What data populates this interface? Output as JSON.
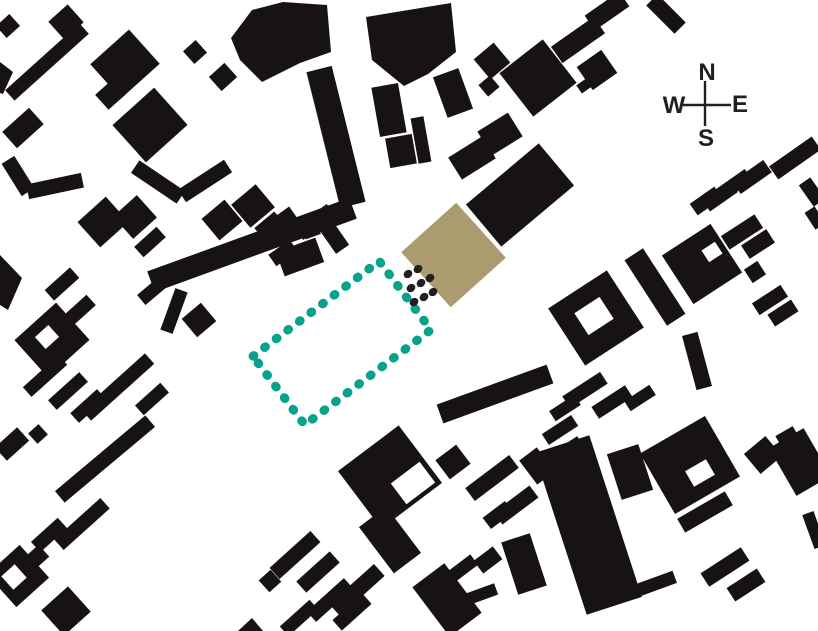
{
  "page": {
    "title": "Figure-ground site plan"
  },
  "colors": {
    "background": "#ffffff",
    "building": "#171314",
    "ink": "#231f20",
    "site_fill": "#ab9c6f",
    "boundary_teal": "#07a28b"
  },
  "compass": {
    "north": "N",
    "east": "E",
    "south": "S",
    "west": "W"
  },
  "map": {
    "width": 818,
    "height": 631,
    "buildings": [
      [
        8,
        26,
        18,
        16,
        -42
      ],
      [
        47,
        62,
        100,
        14,
        -42
      ],
      [
        66,
        22,
        26,
        24,
        -42
      ],
      [
        125,
        64,
        52,
        46,
        -42
      ],
      [
        110,
        95,
        22,
        20,
        -42
      ],
      [
        150,
        125,
        56,
        50,
        -42
      ],
      [
        23,
        128,
        36,
        22,
        -42
      ],
      [
        195,
        52,
        17,
        17,
        -42
      ],
      [
        223,
        77,
        21,
        19,
        -42
      ],
      [
        18,
        176,
        38,
        15,
        58
      ],
      [
        55,
        186,
        56,
        15,
        -12
      ],
      [
        158,
        182,
        55,
        15,
        34
      ],
      [
        205,
        181,
        55,
        15,
        -33
      ],
      [
        62,
        284,
        34,
        14,
        -42
      ],
      [
        52,
        340,
        56,
        50,
        -42
      ],
      [
        80,
        310,
        30,
        14,
        -42
      ],
      [
        103,
        222,
        38,
        34,
        -42
      ],
      [
        135,
        217,
        32,
        30,
        -42
      ],
      [
        150,
        242,
        30,
        14,
        -42
      ],
      [
        252,
        245,
        215,
        22,
        -20
      ],
      [
        222,
        220,
        30,
        28,
        -40
      ],
      [
        253,
        206,
        32,
        30,
        -40
      ],
      [
        272,
        229,
        26,
        24,
        -40
      ],
      [
        300,
        257,
        42,
        26,
        -20
      ],
      [
        311,
        230,
        16,
        14,
        -20
      ],
      [
        152,
        291,
        28,
        13,
        -40
      ],
      [
        174,
        311,
        13,
        44,
        20
      ],
      [
        199,
        320,
        25,
        24,
        -40
      ],
      [
        285,
        218,
        20,
        14,
        -35
      ],
      [
        315,
        222,
        40,
        16,
        -35
      ],
      [
        334,
        237,
        16,
        30,
        -35
      ],
      [
        283,
        253,
        26,
        14,
        -35
      ],
      [
        45,
        376,
        48,
        13,
        -42
      ],
      [
        68,
        391,
        13,
        42,
        48
      ],
      [
        118,
        387,
        85,
        14,
        -42
      ],
      [
        88,
        406,
        13,
        36,
        48
      ],
      [
        152,
        399,
        13,
        34,
        48
      ],
      [
        12,
        444,
        30,
        18,
        -42
      ],
      [
        38,
        434,
        14,
        14,
        -42
      ],
      [
        105,
        459,
        118,
        15,
        -40
      ],
      [
        49,
        535,
        14,
        36,
        48
      ],
      [
        82,
        524,
        62,
        14,
        -42
      ],
      [
        18,
        576,
        44,
        44,
        -42
      ],
      [
        38,
        556,
        16,
        16,
        -42
      ],
      [
        66,
        611,
        36,
        34,
        -42
      ],
      [
        270,
        581,
        16,
        16,
        -42
      ],
      [
        336,
        137,
        26,
        140,
        -14
      ],
      [
        389,
        110,
        27,
        50,
        -10
      ],
      [
        421,
        140,
        13,
        46,
        -10
      ],
      [
        401,
        151,
        27,
        30,
        -10
      ],
      [
        453,
        93,
        27,
        43,
        -20
      ],
      [
        492,
        61,
        26,
        26,
        -40
      ],
      [
        489,
        86,
        15,
        15,
        -40
      ],
      [
        538,
        78,
        55,
        55,
        -38
      ],
      [
        500,
        134,
        36,
        28,
        -32
      ],
      [
        472,
        158,
        40,
        26,
        -32
      ],
      [
        520,
        195,
        95,
        55,
        -40
      ],
      [
        607,
        11,
        42,
        18,
        -35
      ],
      [
        666,
        14,
        40,
        16,
        45
      ],
      [
        578,
        40,
        52,
        20,
        -35
      ],
      [
        597,
        70,
        30,
        28,
        -35
      ],
      [
        584,
        86,
        12,
        10,
        -35
      ],
      [
        795,
        158,
        52,
        16,
        -35
      ],
      [
        752,
        177,
        38,
        15,
        -35
      ],
      [
        734,
        185,
        36,
        14,
        -35
      ],
      [
        720,
        196,
        14,
        34,
        55
      ],
      [
        706,
        201,
        30,
        14,
        -35
      ],
      [
        812,
        192,
        14,
        26,
        -35
      ],
      [
        596,
        318,
        70,
        68,
        -33
      ],
      [
        655,
        287,
        22,
        78,
        -33
      ],
      [
        702,
        264,
        58,
        58,
        -33
      ],
      [
        742,
        232,
        40,
        16,
        -33
      ],
      [
        758,
        244,
        16,
        30,
        57
      ],
      [
        755,
        272,
        16,
        16,
        -33
      ],
      [
        770,
        300,
        34,
        14,
        -33
      ],
      [
        783,
        313,
        14,
        28,
        57
      ],
      [
        697,
        361,
        16,
        56,
        -15
      ],
      [
        585,
        390,
        45,
        14,
        -33
      ],
      [
        612,
        402,
        14,
        40,
        57
      ],
      [
        640,
        398,
        30,
        12,
        -33
      ],
      [
        565,
        408,
        12,
        30,
        57
      ],
      [
        815,
        218,
        12,
        20,
        -33
      ],
      [
        495,
        394,
        117,
        20,
        -20
      ],
      [
        390,
        477,
        76,
        72,
        -37
      ],
      [
        390,
        540,
        34,
        58,
        -37
      ],
      [
        453,
        462,
        26,
        24,
        -37
      ],
      [
        492,
        478,
        55,
        16,
        -37
      ],
      [
        516,
        505,
        45,
        15,
        -37
      ],
      [
        498,
        515,
        14,
        28,
        53
      ],
      [
        537,
        466,
        22,
        30,
        -37
      ],
      [
        295,
        555,
        55,
        15,
        -42
      ],
      [
        318,
        572,
        15,
        45,
        48
      ],
      [
        330,
        600,
        50,
        14,
        -42
      ],
      [
        352,
        612,
        14,
        40,
        48
      ],
      [
        357,
        590,
        60,
        16,
        -42
      ],
      [
        299,
        618,
        40,
        13,
        -42
      ],
      [
        447,
        600,
        40,
        62,
        -37
      ],
      [
        463,
        568,
        28,
        13,
        -37
      ],
      [
        482,
        594,
        30,
        12,
        -20
      ],
      [
        488,
        560,
        24,
        16,
        -37
      ],
      [
        524,
        564,
        30,
        55,
        -18
      ],
      [
        588,
        525,
        58,
        170,
        -18
      ],
      [
        630,
        472,
        33,
        48,
        -18
      ],
      [
        690,
        465,
        75,
        70,
        -30
      ],
      [
        705,
        512,
        55,
        16,
        -30
      ],
      [
        763,
        455,
        28,
        26,
        -40
      ],
      [
        800,
        462,
        40,
        55,
        -30
      ],
      [
        788,
        438,
        20,
        16,
        -30
      ],
      [
        725,
        567,
        48,
        16,
        -33
      ],
      [
        746,
        585,
        16,
        36,
        57
      ],
      [
        655,
        584,
        42,
        13,
        -20
      ],
      [
        814,
        530,
        12,
        36,
        -20
      ],
      [
        560,
        430,
        35,
        13,
        -33
      ],
      [
        570,
        448,
        25,
        12,
        -33
      ]
    ],
    "building_polys": [
      "231,38 252,10 283,2 327,5 331,52 300,63 262,82 240,60",
      "0,62 13,72 3,94 0,93",
      "0,255 22,278 8,310 0,305",
      "238,631 252,618 263,631",
      "366,17 451,3 456,52 428,74 404,86 372,60"
    ],
    "cutouts": [
      [
        47,
        337,
        18,
        16,
        -42
      ],
      [
        14,
        577,
        18,
        18,
        -42
      ],
      [
        594,
        316,
        30,
        26,
        -33
      ],
      [
        712,
        252,
        16,
        14,
        -33
      ],
      [
        413,
        483,
        36,
        26,
        -37
      ],
      [
        700,
        473,
        24,
        18,
        -30
      ]
    ],
    "site_building": [
      453.5,
      255,
      74,
      74,
      -42
    ],
    "boundary": {
      "cx": 342,
      "cy": 343,
      "w": 158,
      "h": 86,
      "angle": -37,
      "stroke_width": 9,
      "dash": "1 13.5"
    },
    "connector_dots": [
      [
        408,
        274
      ],
      [
        418,
        269
      ],
      [
        411,
        288
      ],
      [
        421,
        283
      ],
      [
        430,
        278
      ],
      [
        414,
        302
      ],
      [
        424,
        297
      ],
      [
        433,
        292
      ]
    ],
    "connector_dot_rx": 4.6,
    "connector_dot_ry": 3.9,
    "connector_dot_angle": -38,
    "compass_layout": {
      "lines": [
        [
          683,
          105,
          731,
          105
        ],
        [
          705,
          81,
          705,
          126
        ]
      ],
      "line_width": 2.4,
      "labels": {
        "n": [
          707,
          80
        ],
        "e": [
          740,
          112
        ],
        "s": [
          706,
          146
        ],
        "w": [
          674,
          113
        ]
      }
    }
  }
}
